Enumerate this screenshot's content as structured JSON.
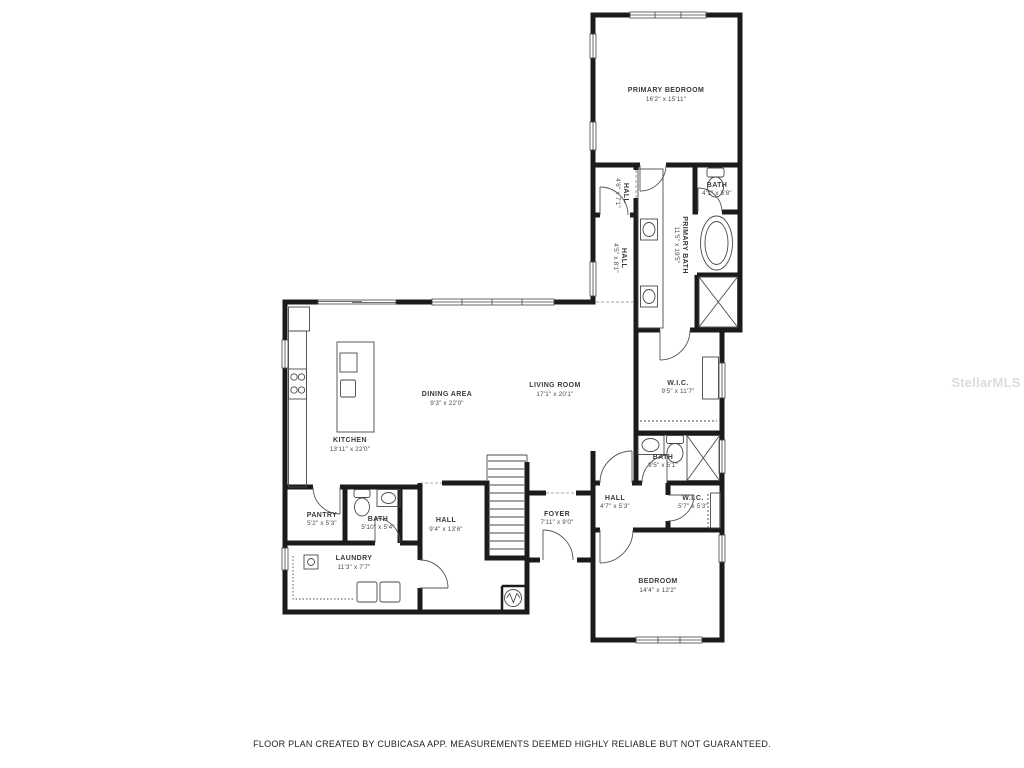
{
  "page": {
    "footer": "FLOOR PLAN CREATED BY CUBICASA APP. MEASUREMENTS DEEMED HIGHLY RELIABLE BUT NOT GUARANTEED.",
    "watermark": "StellarMLS",
    "wall_color": "#1b1b1b",
    "line_color": "#4a4a4a",
    "background": "#ffffff"
  },
  "floor_plan": {
    "rooms": [
      {
        "name": "PRIMARY BEDROOM",
        "dims": "16'2\" x 15'11\""
      },
      {
        "name": "BATH",
        "dims": "4'1\" x 5'8\""
      },
      {
        "name": "HALL",
        "dims": "4'6\" x 7'1\""
      },
      {
        "name": "PRIMARY BATH",
        "dims": "11'5\" x 19'5\""
      },
      {
        "name": "HALL",
        "dims": "4'5\" x 8'1\""
      },
      {
        "name": "DINING AREA",
        "dims": "9'3\" x 22'0\""
      },
      {
        "name": "LIVING ROOM",
        "dims": "17'1\" x 20'1\""
      },
      {
        "name": "KITCHEN",
        "dims": "13'11\" x 22'0\""
      },
      {
        "name": "W.I.C.",
        "dims": "9'5\" x 11'7\""
      },
      {
        "name": "BATH",
        "dims": "9'5\" x 5'1\""
      },
      {
        "name": "HALL",
        "dims": "4'7\" x 5'3\""
      },
      {
        "name": "W.I.C.",
        "dims": "5'7\" x 5'3\""
      },
      {
        "name": "PANTRY",
        "dims": "5'2\" x 5'3\""
      },
      {
        "name": "BATH",
        "dims": "5'10\" x 5'4\""
      },
      {
        "name": "HALL",
        "dims": "9'4\" x 13'6\""
      },
      {
        "name": "LAUNDRY",
        "dims": "11'3\" x 7'7\""
      },
      {
        "name": "FOYER",
        "dims": "7'11\" x 9'0\""
      },
      {
        "name": "BEDROOM",
        "dims": "14'4\" x 12'2\""
      }
    ]
  }
}
